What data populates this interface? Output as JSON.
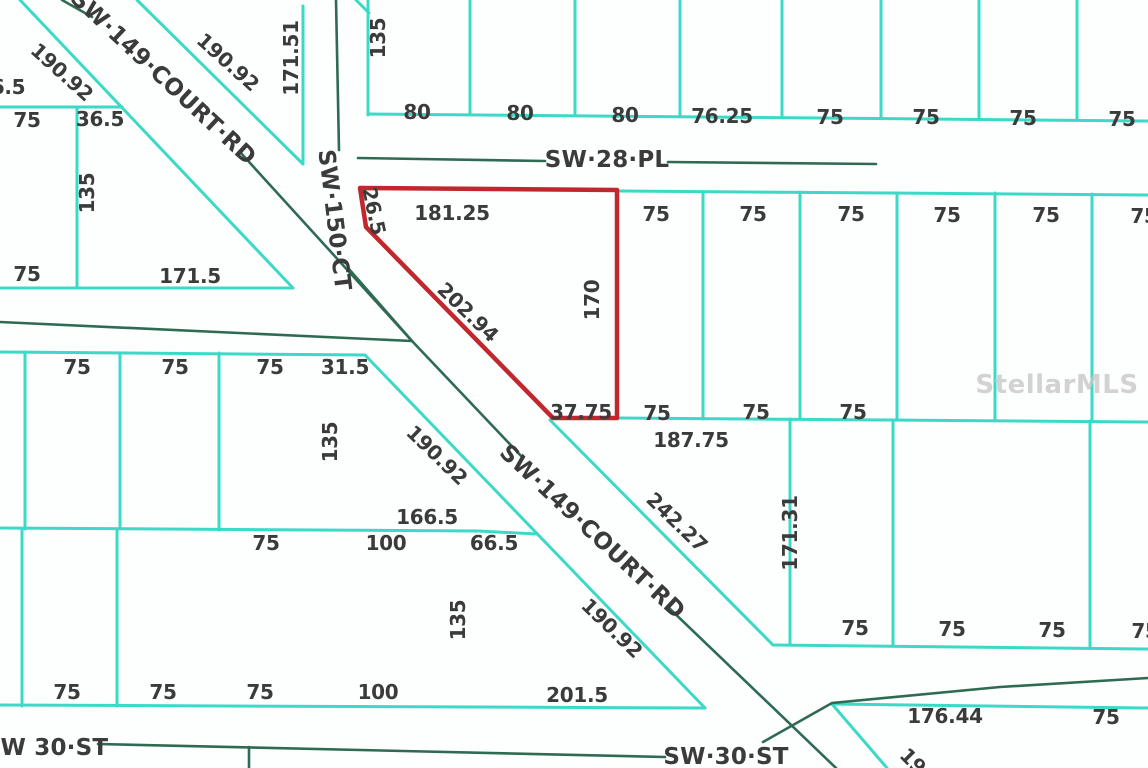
{
  "map": {
    "watermark": "StellarMLS",
    "colors": {
      "lot_line": "#3cd9c6",
      "road_centerline": "#2e6b52",
      "highlighted_parcel": "#c1272d",
      "label_text": "#3b3b3b",
      "watermark_text": "#c8c8c8"
    },
    "street_labels": [
      {
        "text": "SW·149·COURT·RD",
        "x": 163,
        "y": 78,
        "rot": 43
      },
      {
        "text": "SW·150·CT",
        "x": 334,
        "y": 220,
        "rot": 83
      },
      {
        "text": "SW·28·PL",
        "x": 607,
        "y": 160,
        "rot": 0
      },
      {
        "text": "SW·149·COURT·RD",
        "x": 592,
        "y": 532,
        "rot": 43
      },
      {
        "text": "SW 30·ST",
        "x": 46,
        "y": 748,
        "rot": 0
      },
      {
        "text": "SW·30·ST",
        "x": 726,
        "y": 757,
        "rot": 0
      }
    ],
    "dimension_labels": [
      {
        "text": "190.92",
        "x": 62,
        "y": 72,
        "rot": 42
      },
      {
        "text": "6.5",
        "x": 8,
        "y": 87,
        "rot": 0
      },
      {
        "text": "75",
        "x": 27,
        "y": 120,
        "rot": 0
      },
      {
        "text": "36.5",
        "x": 100,
        "y": 119,
        "rot": 0
      },
      {
        "text": "135",
        "x": 87,
        "y": 193,
        "rot": -90
      },
      {
        "text": "75",
        "x": 27,
        "y": 274,
        "rot": 0
      },
      {
        "text": "171.5",
        "x": 190,
        "y": 276,
        "rot": 0
      },
      {
        "text": "190.92",
        "x": 228,
        "y": 62,
        "rot": 42
      },
      {
        "text": "171.51",
        "x": 291,
        "y": 58,
        "rot": -90
      },
      {
        "text": "135",
        "x": 378,
        "y": 38,
        "rot": -90
      },
      {
        "text": "80",
        "x": 417,
        "y": 112,
        "rot": 0
      },
      {
        "text": "80",
        "x": 520,
        "y": 113,
        "rot": 0
      },
      {
        "text": "80",
        "x": 625,
        "y": 115,
        "rot": 0
      },
      {
        "text": "76.25",
        "x": 722,
        "y": 116,
        "rot": 0
      },
      {
        "text": "75",
        "x": 830,
        "y": 117,
        "rot": 0
      },
      {
        "text": "75",
        "x": 926,
        "y": 117,
        "rot": 0
      },
      {
        "text": "75",
        "x": 1023,
        "y": 118,
        "rot": 0
      },
      {
        "text": "75",
        "x": 1122,
        "y": 119,
        "rot": 0
      },
      {
        "text": "75",
        "x": 656,
        "y": 214,
        "rot": 0
      },
      {
        "text": "75",
        "x": 753,
        "y": 214,
        "rot": 0
      },
      {
        "text": "75",
        "x": 851,
        "y": 214,
        "rot": 0
      },
      {
        "text": "75",
        "x": 947,
        "y": 215,
        "rot": 0
      },
      {
        "text": "75",
        "x": 1046,
        "y": 215,
        "rot": 0
      },
      {
        "text": "75",
        "x": 1144,
        "y": 216,
        "rot": 0
      },
      {
        "text": "26.5",
        "x": 374,
        "y": 211,
        "rot": 78
      },
      {
        "text": "181.25",
        "x": 452,
        "y": 213,
        "rot": 0
      },
      {
        "text": "202.94",
        "x": 468,
        "y": 312,
        "rot": 44
      },
      {
        "text": "170",
        "x": 592,
        "y": 300,
        "rot": -90
      },
      {
        "text": "37.75",
        "x": 581,
        "y": 412,
        "rot": 0
      },
      {
        "text": "75",
        "x": 77,
        "y": 367,
        "rot": 0
      },
      {
        "text": "75",
        "x": 175,
        "y": 367,
        "rot": 0
      },
      {
        "text": "75",
        "x": 270,
        "y": 367,
        "rot": 0
      },
      {
        "text": "31.5",
        "x": 345,
        "y": 367,
        "rot": 0
      },
      {
        "text": "135",
        "x": 330,
        "y": 442,
        "rot": -90
      },
      {
        "text": "190.92",
        "x": 437,
        "y": 455,
        "rot": 44
      },
      {
        "text": "166.5",
        "x": 427,
        "y": 517,
        "rot": 0
      },
      {
        "text": "75",
        "x": 266,
        "y": 543,
        "rot": 0
      },
      {
        "text": "100",
        "x": 386,
        "y": 543,
        "rot": 0
      },
      {
        "text": "66.5",
        "x": 494,
        "y": 543,
        "rot": 0
      },
      {
        "text": "75",
        "x": 657,
        "y": 413,
        "rot": 0
      },
      {
        "text": "187.75",
        "x": 691,
        "y": 440,
        "rot": 0
      },
      {
        "text": "75",
        "x": 756,
        "y": 412,
        "rot": 0
      },
      {
        "text": "75",
        "x": 853,
        "y": 412,
        "rot": 0
      },
      {
        "text": "242.27",
        "x": 677,
        "y": 522,
        "rot": 44
      },
      {
        "text": "171.31",
        "x": 790,
        "y": 533,
        "rot": -90
      },
      {
        "text": "190.92",
        "x": 612,
        "y": 628,
        "rot": 44
      },
      {
        "text": "135",
        "x": 458,
        "y": 620,
        "rot": -90
      },
      {
        "text": "75",
        "x": 67,
        "y": 692,
        "rot": 0
      },
      {
        "text": "75",
        "x": 163,
        "y": 692,
        "rot": 0
      },
      {
        "text": "75",
        "x": 260,
        "y": 692,
        "rot": 0
      },
      {
        "text": "100",
        "x": 378,
        "y": 692,
        "rot": 0
      },
      {
        "text": "201.5",
        "x": 577,
        "y": 695,
        "rot": 0
      },
      {
        "text": "75",
        "x": 855,
        "y": 628,
        "rot": 0
      },
      {
        "text": "75",
        "x": 952,
        "y": 629,
        "rot": 0
      },
      {
        "text": "75",
        "x": 1052,
        "y": 630,
        "rot": 0
      },
      {
        "text": "75",
        "x": 1145,
        "y": 631,
        "rot": 0
      },
      {
        "text": "176.44",
        "x": 945,
        "y": 716,
        "rot": 0
      },
      {
        "text": "75",
        "x": 1106,
        "y": 717,
        "rot": 0
      },
      {
        "text": "19",
        "x": 913,
        "y": 761,
        "rot": 45
      }
    ]
  }
}
